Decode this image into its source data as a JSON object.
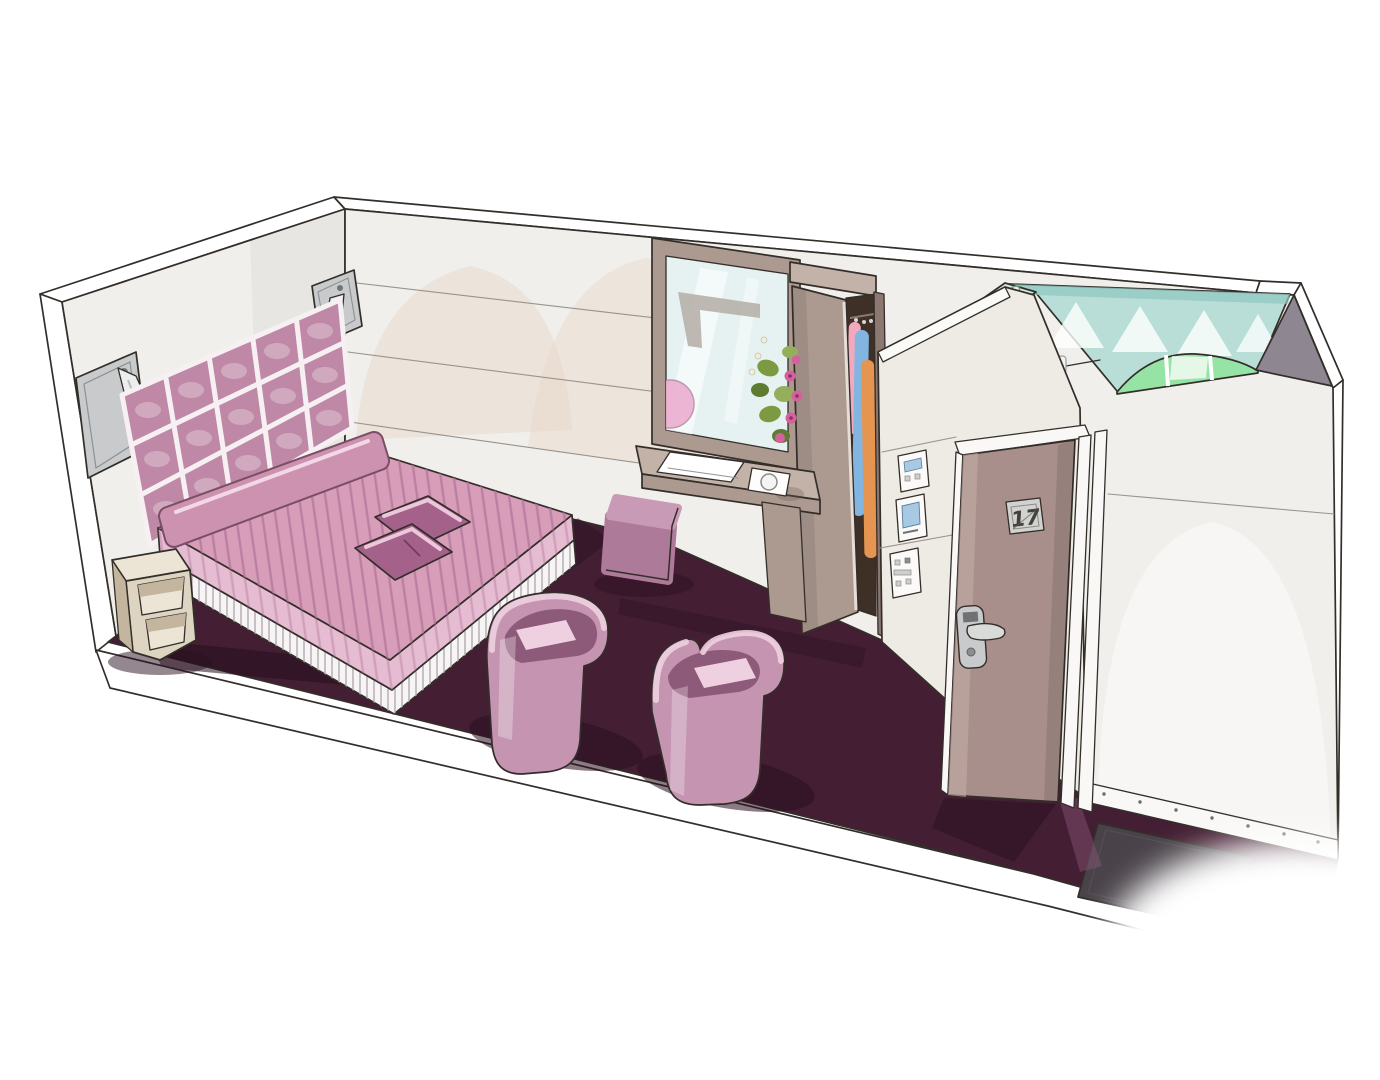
{
  "scene_label": "Hand-drawn hotel bedroom interior sketch, pink and plum palette",
  "door": {
    "number_plate": "17"
  },
  "colors": {
    "ink": "#332e29",
    "inkSoft": "#9a938c",
    "paper": "#ffffff",
    "wall": "#f1efec",
    "wallShade": "#e4e1dc",
    "wallWarm": "#eeeae4",
    "archGhost": "#e8d8c9",
    "carpet": "#441f33",
    "carpetShadow": "#250e1d",
    "mat": "#494349",
    "floorEdge": "#ffffff",
    "taupe": "#ac9990",
    "taupeLight": "#c2b2a8",
    "taupeDark": "#8c7870",
    "cream": "#ded4c2",
    "creamShade": "#c3b59e",
    "creamLight": "#ece4d4",
    "doorLeaf": "#a88f8b",
    "doorLeafHi": "#c3aba6",
    "frame": "#f9f8f6",
    "metal": "#c8cacb",
    "metalDark": "#85898b",
    "headboard": "#bf88a6",
    "headboardGap": "#f6f0f3",
    "spread": "#d89db9",
    "spreadStripe": "#b27799",
    "spreadLight": "#e5bcd1",
    "bolster": "#cd92b0",
    "cushion": "#a4628a",
    "cushionHi": "#ecc6da",
    "skirt": "#f7f4f5",
    "chair": "#c494b0",
    "chairHi": "#eed0e0",
    "chairShadow": "#8e5a7a",
    "pouf": "#ad7a99",
    "poufHi": "#c99ab6",
    "mirrorGlass": "#e6f2f2",
    "mirrorReflection": "#b3aea6",
    "glassTeal": "#b9ded8",
    "glassTealDeep": "#8fc7bf",
    "glassGreen": "#96e4a5",
    "grayPanel": "#8e8690",
    "wardrobeInt": "#3e2f27",
    "clothPink": "#f2a9bd",
    "clothBlue": "#82b6e1",
    "clothOrange": "#e59550",
    "clothRed": "#cd5045",
    "leaf": "#7c9a42",
    "leafDark": "#5d7c31",
    "blossom": "#d5609e",
    "blossomDark": "#8e2f63",
    "screenBlue": "#a7c9e3",
    "buttonGray": "#cfcfcf",
    "shadow": "#2a0f1f",
    "white": "#ffffff"
  }
}
